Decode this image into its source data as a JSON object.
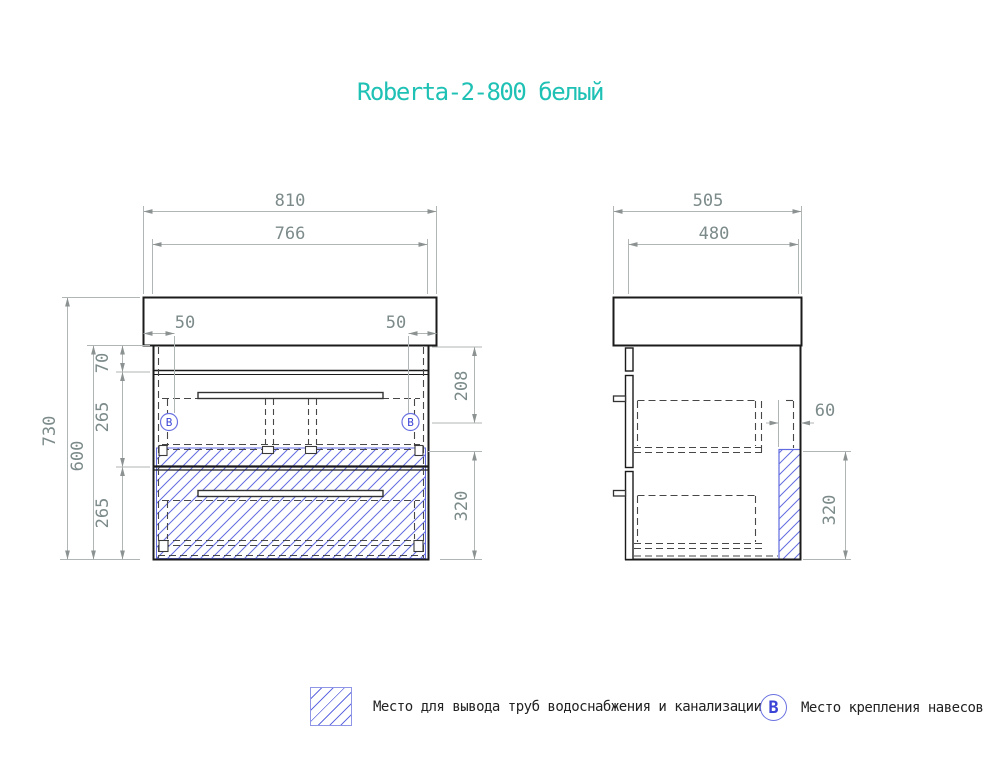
{
  "title": "Roberta-2-800 белый",
  "front_view": {
    "dims": {
      "width_countertop": "810",
      "width_cabinet": "766",
      "inset_left": "50",
      "inset_right": "50",
      "height_total": "730",
      "height_cabinet": "600",
      "top_gap": "70",
      "upper_drawer": "265",
      "lower_drawer": "265",
      "mount_offset": "208",
      "pipe_zone_height": "320"
    },
    "mount_symbol": "В"
  },
  "side_view": {
    "dims": {
      "depth_countertop": "505",
      "depth_cabinet": "480",
      "pipe_zone_width": "60",
      "pipe_zone_height": "320"
    }
  },
  "legend": {
    "hatch_label": "Место для вывода труб водоснабжения и канализации",
    "mount_symbol": "В",
    "mount_label": "Место крепления навесов"
  },
  "colors": {
    "accent_teal": "#1fc1b5",
    "hatch_blue": "#626bdf",
    "mount_blue": "#3a43d6",
    "dim_gray": "#7c8a8a",
    "line_dark": "#1b1b1b"
  }
}
